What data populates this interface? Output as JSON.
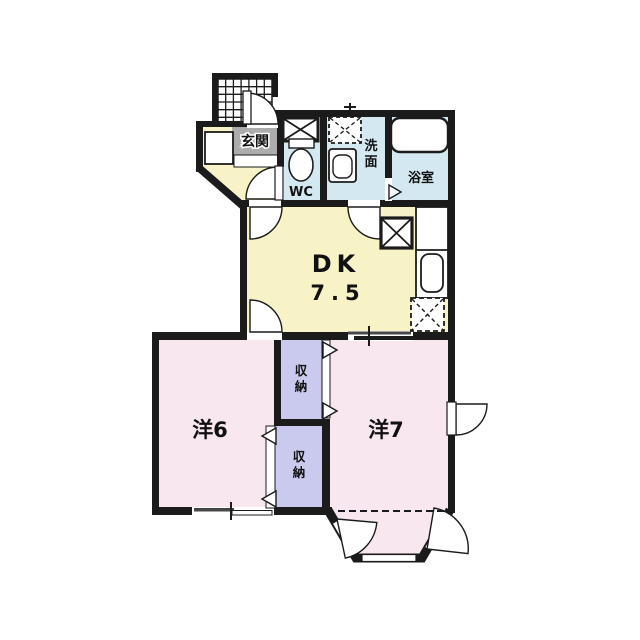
{
  "colors": {
    "background": "#ffffff",
    "wall": "#1b1b1b",
    "dk_floor": "#f8f3c6",
    "room_floor": "#f9e7ef",
    "wet_floor": "#d4e8f1",
    "storage_floor": "#cacaee",
    "entrance_floor": "#acacac"
  },
  "rooms": {
    "entrance": {
      "label": "玄関"
    },
    "toilet": {
      "label": "WC"
    },
    "washroom": {
      "label_chars": [
        "洗",
        "面"
      ]
    },
    "bathroom": {
      "label": "浴室"
    },
    "dining_kitchen": {
      "label": "DK",
      "size": "7.5"
    },
    "western_room_6": {
      "label": "洋6"
    },
    "western_room_7": {
      "label": "洋7"
    },
    "storage_upper": {
      "label_chars": [
        "収",
        "納"
      ]
    },
    "storage_lower": {
      "label_chars": [
        "収",
        "納"
      ]
    }
  }
}
